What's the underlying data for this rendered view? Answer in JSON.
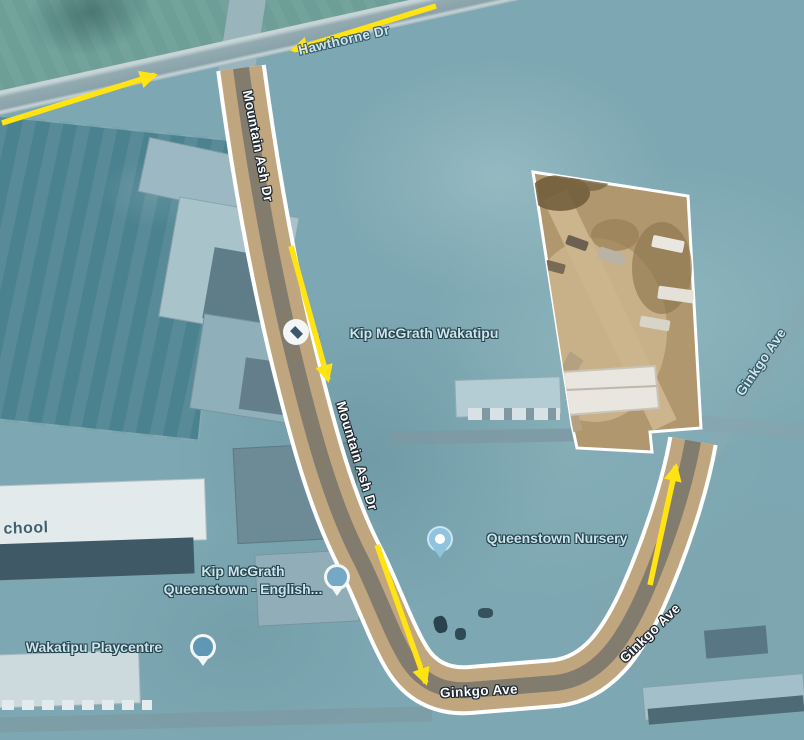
{
  "map": {
    "kind": "satellite-route-map",
    "colors": {
      "overlay_teal": "#7da7b2",
      "route_border": "#ffffff",
      "route_fill": "#c0a67e",
      "route_road": "#77746c",
      "arrow_yellow": "#ffe312",
      "parcel_fill": "#b0976d",
      "label_outline_dark": "#1c262e",
      "poi_text": "#cfe3ea"
    },
    "road_labels": [
      {
        "id": "hawthorne-dr",
        "text": "Hawthorne Dr",
        "x": 344,
        "y": 40,
        "rot": -13,
        "variant": "filtered"
      },
      {
        "id": "mountain-ash-dr-upper",
        "text": "Mountain Ash Dr",
        "x": 258,
        "y": 146,
        "rot": 79,
        "variant": "route"
      },
      {
        "id": "mountain-ash-dr-lower",
        "text": "Mountain Ash Dr",
        "x": 357,
        "y": 456,
        "rot": 73,
        "variant": "route"
      },
      {
        "id": "ginkgo-ave-right",
        "text": "Ginkgo Ave",
        "x": 761,
        "y": 362,
        "rot": -56,
        "variant": "filtered"
      },
      {
        "id": "ginkgo-ave-curve",
        "text": "Ginkgo Ave",
        "x": 650,
        "y": 633,
        "rot": -44,
        "variant": "route"
      },
      {
        "id": "ginkgo-ave-bottom",
        "text": "Ginkgo Ave",
        "x": 479,
        "y": 691,
        "rot": -3,
        "variant": "route"
      },
      {
        "id": "school-partial",
        "text": "chool",
        "x": 26,
        "y": 529,
        "rot": -2,
        "variant": "building"
      }
    ],
    "poi_labels": [
      {
        "id": "kip-mcgrath-wakatipu",
        "lines": [
          "Kip McGrath Wakatipu"
        ],
        "tx": 424,
        "ty": 333,
        "icon": "education-circle-icon",
        "ix": 296,
        "iy": 332
      },
      {
        "id": "queenstown-nursery",
        "lines": [
          "Queenstown Nursery"
        ],
        "tx": 557,
        "ty": 538,
        "icon": "nursery-pin-icon",
        "ix": 440,
        "iy": 539
      },
      {
        "id": "kip-mcgrath-queenstown-english",
        "lines": [
          "Kip McGrath",
          "Queenstown - English..."
        ],
        "tx": 243,
        "ty": 580,
        "icon": "place-pin-icon",
        "ix": 337,
        "iy": 577
      },
      {
        "id": "wakatipu-playcentre",
        "lines": [
          "Wakatipu Playcentre"
        ],
        "tx": 94,
        "ty": 647,
        "icon": "education-pin-icon",
        "ix": 203,
        "iy": 647
      }
    ],
    "route_arrows": [
      {
        "id": "hawthorne-west-arrow",
        "x1": 2,
        "y1": 123,
        "x2": 155,
        "y2": 75
      },
      {
        "id": "hawthorne-east-arrow",
        "x1": 436,
        "y1": 6,
        "x2": 293,
        "y2": 50
      },
      {
        "id": "mountain-ash-upper-arrow",
        "x1": 291,
        "y1": 246,
        "x2": 328,
        "y2": 380
      },
      {
        "id": "mountain-ash-lower-arrow",
        "x1": 377,
        "y1": 545,
        "x2": 426,
        "y2": 683
      },
      {
        "id": "ginkgo-arrow",
        "x1": 650,
        "y1": 585,
        "x2": 676,
        "y2": 466
      }
    ]
  }
}
